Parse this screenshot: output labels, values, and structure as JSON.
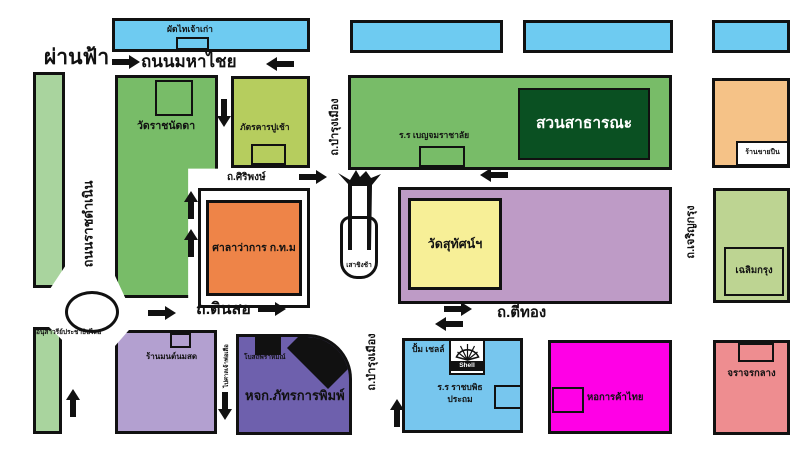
{
  "map": {
    "roads": {
      "phan_fa": "ผ่านฟ้า",
      "maha_chai": "ถนนมหาไชย",
      "ratchadamnoen": "ถนนราชดำเนิน",
      "bamrung_mueang_upper": "ถ.บำรุงเมือง",
      "bamrung_mueang_lower": "ถ.บำรุงเมือง",
      "siriphong": "ถ.ศิริพงษ์",
      "dinso": "ถ.ดินสอ",
      "ti_thong": "ถ.ตีทอง",
      "charoen_krung": "ถ.เจริญกรุง",
      "to_tiger_shrine": "ไปศาลเจ้าพ่อเสือ"
    },
    "places": {
      "phat_thai_stall": "ผัดไทเจ้าเก่า",
      "wat_ratchanatda": "วัดราชนัดดา",
      "pu_chao_restaurant": "ภัตรคารปูเช้า",
      "city_hall": "ศาลาว่าการ ก.ท.ม",
      "democracy_monument": "อนุสาวรีย์ประชาธิปไตย",
      "benjamarachalai_school": "ร.ร เบญจมราชาลัย",
      "public_park": "สวนสาธารณะ",
      "gun_shop": "ร้านขายปืน",
      "wat_suthat": "วัดสุทัศน์ฯ",
      "giant_swing": "เสาชิงช้า",
      "chalermkrung": "เฉลิมกรุง",
      "mont_nom_sot_shop": "ร้านมนต์นมสด",
      "brahmin_temple": "โบสถ์พราหมณ์",
      "pattara_printing": "หจก.ภัทรการพิมพ์",
      "shell_station": "ปั้ม เชลล์",
      "shell_brand": "Shell",
      "rajabopit_school_line1": "ร.ร ราชบพิธ",
      "rajabopit_school_line2": "ประถม",
      "thai_chamber_of_commerce": "หอการค้าไทย",
      "central_traffic": "จราจรกลาง"
    },
    "colors": {
      "outline": "#111111",
      "road_background": "#ffffff",
      "blue_shophouse": "#6ecbf1",
      "pale_green_strip": "#a9d49e",
      "green_block": "#78bc68",
      "yellow_green_block": "#b6cd5e",
      "dark_green_park": "#0a5022",
      "orange_city_hall": "#ee8448",
      "tan_gun_shop": "#f5c287",
      "mauve_block": "#be9bc6",
      "pale_yellow_wat": "#f7ef97",
      "lavender_block": "#b3a0d0",
      "slate_purple_block": "#6e60ad",
      "light_blue_block": "#77c6ee",
      "magenta_block": "#ff00e6",
      "salmon_block": "#ee8d90",
      "light_green_theatre": "#bdd492"
    }
  }
}
